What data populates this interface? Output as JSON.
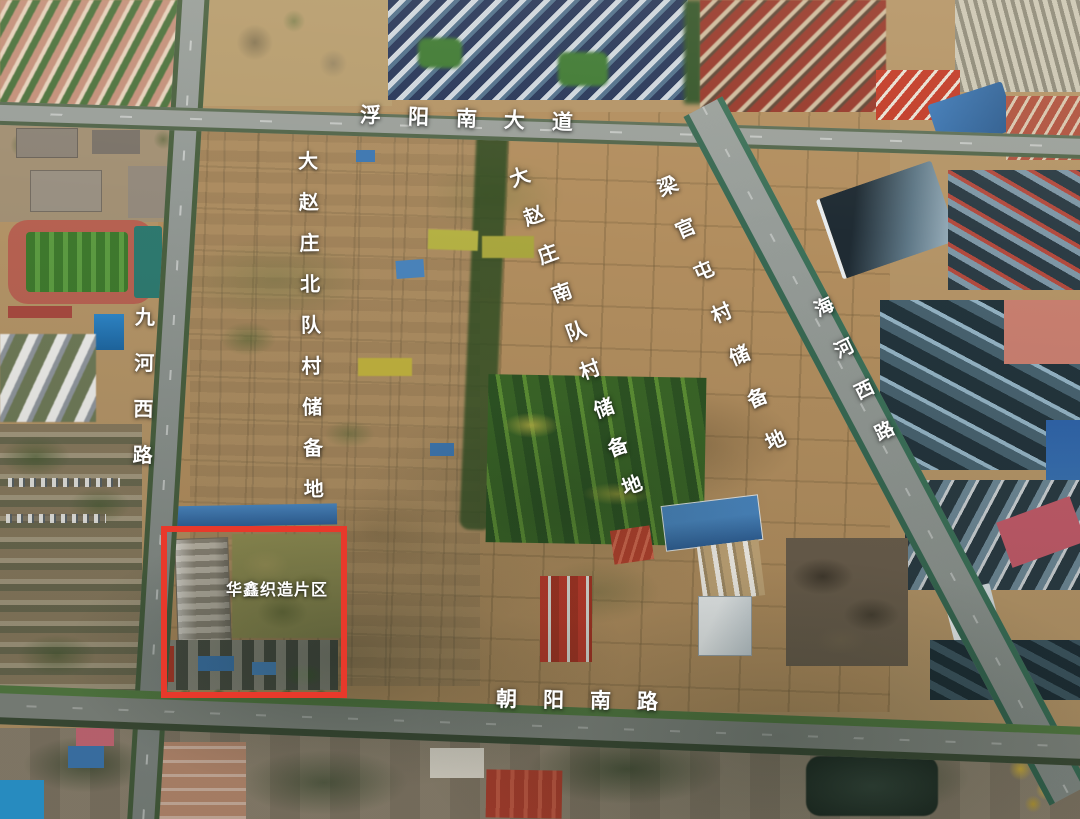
{
  "annotations": {
    "roads": [
      {
        "name": "fuyang-south-avenue",
        "label": "浮阳南大道"
      },
      {
        "name": "jiuhe-west-road",
        "label": "九河西路"
      },
      {
        "name": "haihe-west-road",
        "label": "海河西路"
      },
      {
        "name": "chaoyang-south-road",
        "label": "朝阳南路"
      }
    ],
    "zones": [
      {
        "name": "dazhaozhuang-north-team-village-reserve-land",
        "label": "大赵庄北队村储备地"
      },
      {
        "name": "dazhaozhuang-south-team-village-reserve-land",
        "label": "大赵庄南队村储备地"
      },
      {
        "name": "liangguantun-village-reserve-land",
        "label": "梁官屯村储备地"
      }
    ],
    "highlighted_area": {
      "name": "huaxin-weaving-district",
      "label": "华鑫织造片区",
      "box_color": "#e8392b"
    }
  },
  "colors": {
    "highlight_box": "#e8392b",
    "label_text": "#ffffff",
    "farmland": "#b49467",
    "road": "#8f938f",
    "trees": "#3c5a2b",
    "sports_field": "#4e8a38",
    "running_track": "#bd6550",
    "blue_roofs": "#3f78b2"
  }
}
